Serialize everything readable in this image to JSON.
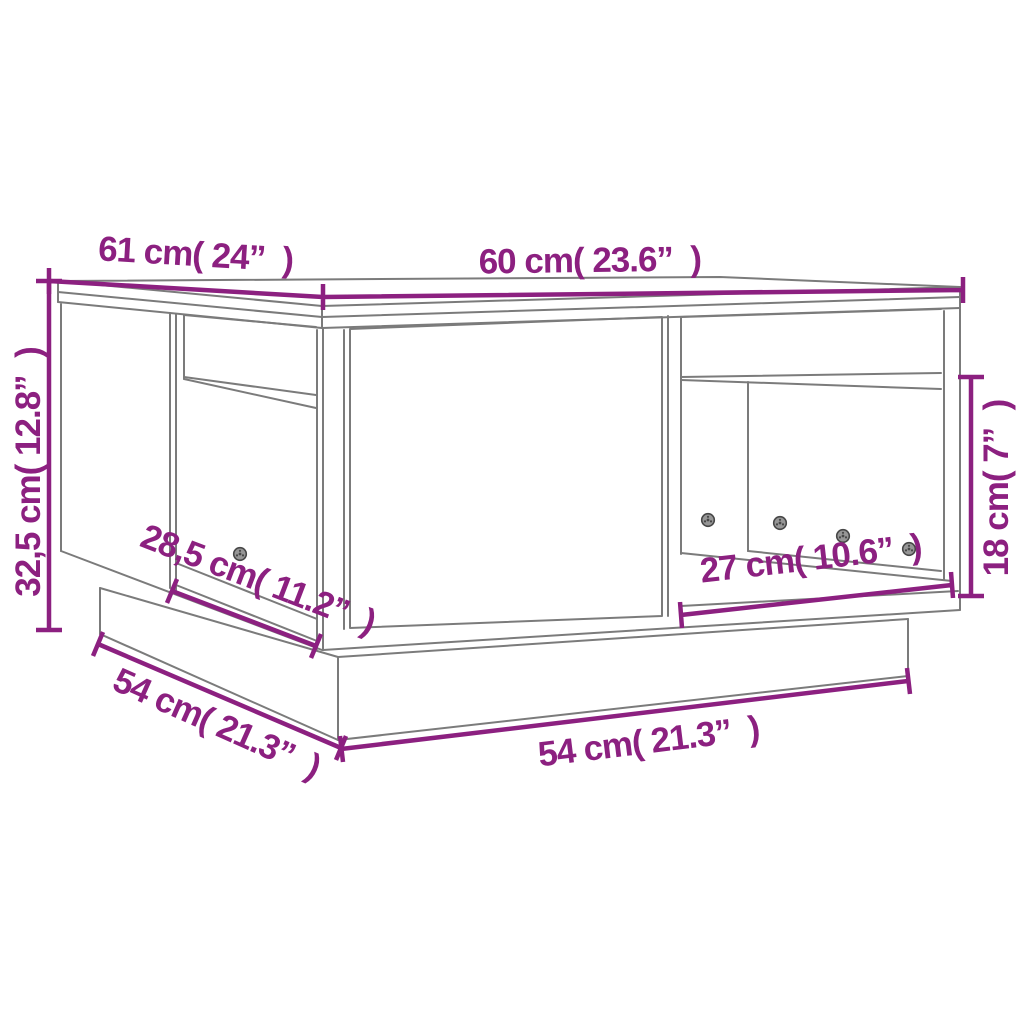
{
  "diagram": {
    "subject": "coffee table dimension drawing",
    "background_color": "#ffffff",
    "outline_color": "#7b7b7b",
    "dimension_color": "#8C2080",
    "dimensions": {
      "depth_top": "61 cm( 24”  )",
      "width_top": "60 cm( 23.6”  )",
      "height": "32,5 cm( 12.8”  )",
      "left_opening_width": "28,5 cm( 11.2”  )",
      "base_depth": "54 cm( 21.3”  )",
      "base_width": "54 cm( 21.3”  )",
      "right_opening_width": "27 cm( 10.6”  )",
      "right_opening_height": "18 cm( 7”  )"
    },
    "screw_count": 5
  }
}
